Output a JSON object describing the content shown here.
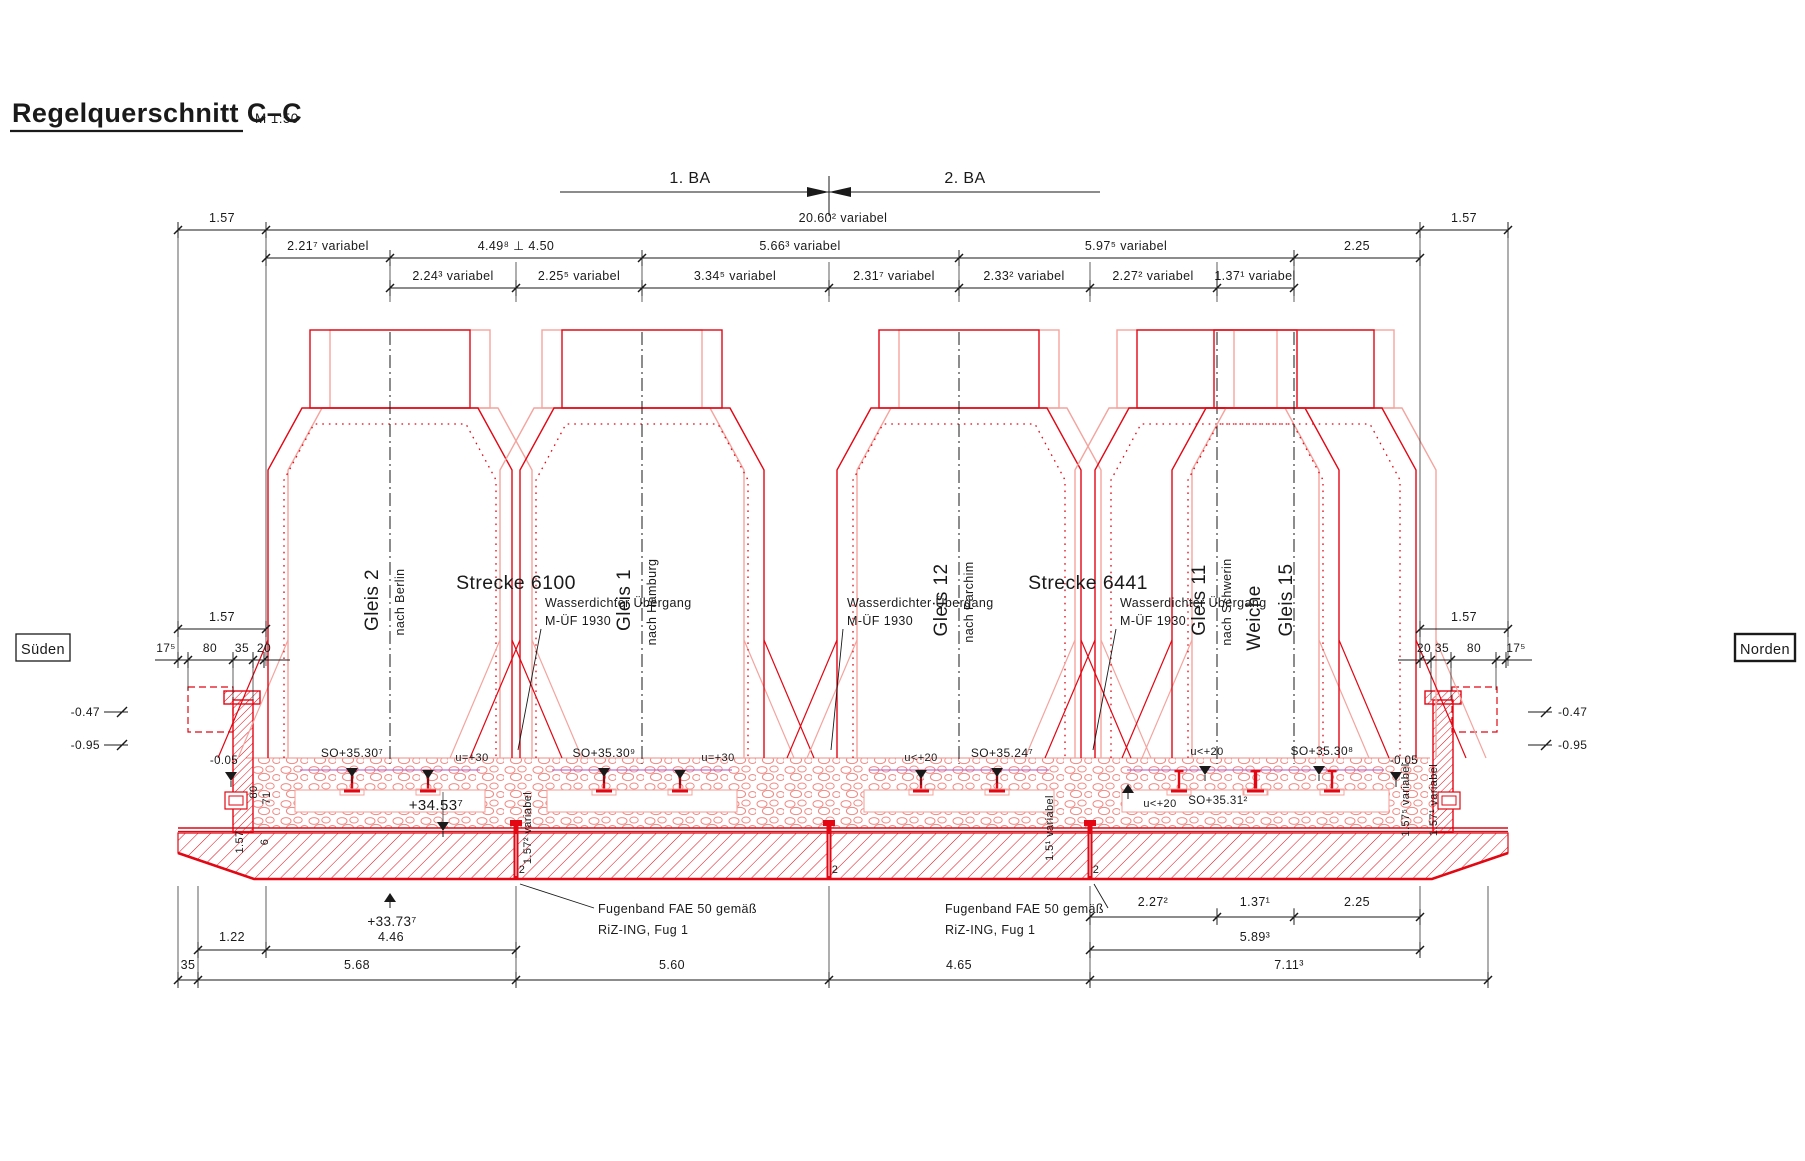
{
  "title": {
    "text": "Regelquerschnitt C–C",
    "scale": "M 1:50"
  },
  "colors": {
    "drawing_red": "#e30613",
    "light_red": "#f4a49e",
    "ink": "#1a1a1a",
    "cant_line": "#b050c8",
    "paper": "#ffffff"
  },
  "phases": [
    "1. BA",
    "2. BA"
  ],
  "orientation": {
    "left": "Süden",
    "right": "Norden"
  },
  "dimensions": {
    "top_row1": [
      "1.57",
      "20.60² variabel",
      "1.57"
    ],
    "top_row2": [
      "2.21⁷ variabel",
      "4.49⁸ ⊥ 4.50",
      "5.66³ variabel",
      "5.97⁵ variabel",
      "2.25"
    ],
    "top_row3": [
      "2.24³ variabel",
      "2.25⁵ variabel",
      "3.34⁵ variabel",
      "2.31⁷ variabel",
      "2.33² variabel",
      "2.27² variabel",
      "1.37¹ variabel"
    ],
    "left_total": "1.57",
    "left_parts": [
      "17⁵",
      "80",
      "35",
      "20"
    ],
    "right_total": "1.57",
    "right_parts": [
      "20",
      "35",
      "80",
      "17⁵"
    ],
    "left_vertical": [
      "1.57",
      "80",
      "6",
      "71"
    ],
    "joint_heights": [
      "1.57² variabel",
      "1.5¹ variabel",
      "1.57⁵ variabel",
      "1.57¹ variabel"
    ],
    "joint_width": "2",
    "bottom_row1": [
      "1.22",
      "4.46"
    ],
    "bottom_right_row1": [
      "2.27²",
      "1.37¹",
      "2.25"
    ],
    "bottom_right_row2": [
      "5.89³"
    ],
    "bottom_row2": [
      "35",
      "5.68",
      "5.60",
      "4.65",
      "7.11³"
    ]
  },
  "tracks": [
    {
      "name": "Gleis 2",
      "direction": "nach Berlin"
    },
    {
      "name": "Gleis 1",
      "direction": "nach Hamburg"
    },
    {
      "name": "Gleis 12",
      "direction": "nach Parchim"
    },
    {
      "name": "Gleis 11",
      "direction": "nach Schwerin"
    },
    {
      "name": "Gleis 15",
      "direction": ""
    }
  ],
  "switch_label": "Weiche",
  "lines": [
    {
      "label": "Strecke 6100"
    },
    {
      "label": "Strecke 6441"
    }
  ],
  "levels": {
    "left_edge": "-0.05",
    "right_edge": "-0.05",
    "left_outer": [
      "-0.47",
      "-0.95"
    ],
    "right_outer": [
      "-0.47",
      "-0.95"
    ],
    "rail_tops": [
      "SO+35.30⁷",
      "SO+35.30⁹",
      "SO+35.24⁷",
      "SO+35.31²",
      "SO+35.30⁸"
    ],
    "cant": [
      "u=+30",
      "u=+30",
      "u<+20",
      "u<+20",
      "u<+20"
    ],
    "ballast_top": "+34.53⁷",
    "slab_bottom": "+33.73⁷"
  },
  "annotations": {
    "waterproof": {
      "line1": "Wasserdichter Übergang",
      "line2": "M-ÜF 1930"
    },
    "joint_tape": {
      "line1": "Fugenband FAE 50 gemäß",
      "line2": "RiZ-ING, Fug 1"
    }
  }
}
